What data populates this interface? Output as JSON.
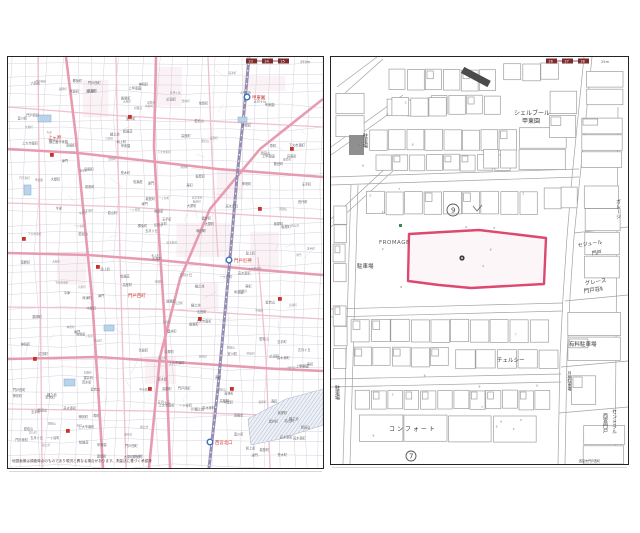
{
  "page": {
    "bg": "#ffffff"
  },
  "colors": {
    "border": "#242424",
    "road_major": "#e79bb0",
    "road_minor": "#efc0cd",
    "railway": "#968db2",
    "grid": "#cfc9d8",
    "tiny_text": "#6b6b74",
    "red": "#c9322b",
    "red_text": "#d0342c",
    "blue_stroke": "#3a6fc0",
    "pond_fill": "#b9d4ea",
    "pond_stroke": "#7fa8cc",
    "tint": "#f7e7ec",
    "river_fill": "#edf1f7",
    "river_hatch": "#9aa6bd",
    "tab_box": "#7e2b2b",
    "bldg_stroke": "#9e9e9e",
    "street": "#a3a3a3",
    "parcel_pink": "#dc4870",
    "dark_bldg": "#4a4a4a",
    "grey_bldg": "#8f8f8f",
    "label_dark": "#3a3a3a",
    "green_mark": "#3a8a4a"
  },
  "left_map": {
    "page_tabs": [
      "23",
      "24",
      "25"
    ],
    "scale_note": "250m",
    "caption": "地図画像は調査時点のものであり現況と異なる場合があります。測量法に基づく承認済",
    "railway": [
      [
        241,
        0
      ],
      [
        236,
        55
      ],
      [
        229,
        120
      ],
      [
        223,
        190
      ],
      [
        217,
        255
      ],
      [
        210,
        330
      ],
      [
        201,
        411
      ]
    ],
    "stations": [
      {
        "x": 239,
        "y": 40,
        "label": "甲東園"
      },
      {
        "x": 221,
        "y": 203,
        "label": "門戸厄神"
      },
      {
        "x": 202,
        "y": 385,
        "label": "西宮北口"
      }
    ],
    "red_labels": [
      {
        "t": "門戸西町",
        "x": 120,
        "y": 240
      },
      {
        "t": "上ヶ原",
        "x": 40,
        "y": 82
      }
    ],
    "roads_major": [
      [
        [
          0,
          92
        ],
        [
          70,
          96
        ],
        [
          140,
          104
        ],
        [
          210,
          112
        ],
        [
          315,
          120
        ]
      ],
      [
        [
          0,
          196
        ],
        [
          80,
          198
        ],
        [
          160,
          204
        ],
        [
          240,
          212
        ],
        [
          315,
          218
        ]
      ],
      [
        [
          0,
          302
        ],
        [
          90,
          300
        ],
        [
          180,
          306
        ],
        [
          270,
          312
        ],
        [
          315,
          314
        ]
      ],
      [
        [
          58,
          0
        ],
        [
          68,
          80
        ],
        [
          76,
          160
        ],
        [
          84,
          240
        ],
        [
          90,
          330
        ],
        [
          95,
          411
        ]
      ],
      [
        [
          148,
          0
        ],
        [
          146,
          90
        ],
        [
          151,
          180
        ],
        [
          157,
          270
        ],
        [
          162,
          411
        ]
      ],
      [
        [
          315,
          42
        ],
        [
          252,
          92
        ],
        [
          202,
          152
        ],
        [
          172,
          222
        ],
        [
          152,
          300
        ],
        [
          141,
          411
        ]
      ]
    ],
    "roads_minor": [
      [
        [
          0,
          50
        ],
        [
          100,
          58
        ],
        [
          200,
          64
        ],
        [
          315,
          70
        ]
      ],
      [
        [
          0,
          146
        ],
        [
          120,
          150
        ],
        [
          240,
          158
        ],
        [
          315,
          162
        ]
      ],
      [
        [
          0,
          250
        ],
        [
          150,
          252
        ],
        [
          315,
          262
        ]
      ],
      [
        [
          0,
          352
        ],
        [
          140,
          354
        ],
        [
          315,
          360
        ]
      ],
      [
        [
          30,
          0
        ],
        [
          34,
          411
        ]
      ],
      [
        [
          108,
          0
        ],
        [
          112,
          200
        ],
        [
          118,
          411
        ]
      ],
      [
        [
          200,
          0
        ],
        [
          204,
          100
        ],
        [
          210,
          200
        ]
      ],
      [
        [
          250,
          200
        ],
        [
          258,
          300
        ],
        [
          262,
          411
        ]
      ]
    ],
    "red_squares": [
      [
        58,
        372
      ],
      [
        25,
        300
      ],
      [
        88,
        208
      ],
      [
        140,
        330
      ],
      [
        250,
        150
      ],
      [
        42,
        96
      ],
      [
        190,
        260
      ],
      [
        282,
        90
      ],
      [
        120,
        58
      ],
      [
        222,
        330
      ],
      [
        270,
        240
      ],
      [
        14,
        180
      ]
    ],
    "ponds": [
      [
        30,
        58,
        13,
        7
      ],
      [
        96,
        268,
        10,
        6
      ],
      [
        56,
        322,
        11,
        7
      ],
      [
        16,
        128,
        7,
        10
      ],
      [
        230,
        60,
        9,
        5
      ]
    ],
    "river": "240,362 278,342 315,332 315,368 272,382 243,388",
    "scatter_names": [
      "上甲東園",
      "甲東園",
      "段上町",
      "上大市南町",
      "下大市東町",
      "門戸東町",
      "門戸西町",
      "岡田山",
      "神呪町",
      "樋之池",
      "荒木町",
      "薬師町",
      "丸橋町",
      "高木東町",
      "伏原町",
      "一ヶ谷町",
      "松籟荘",
      "若山町",
      "大屋町",
      "中屋町",
      "板屋町",
      "能登町",
      "郷免町",
      "玉手町",
      "室川町",
      "寿町",
      "常磐町",
      "和上町",
      "染殿町",
      "津門",
      "今津",
      "広田町",
      "愛宕山",
      "六軒町",
      "藤田町",
      "深津町",
      "高座町",
      "田代町",
      "五月ヶ丘",
      "雲井町"
    ]
  },
  "right_map": {
    "page_tabs": [
      "26",
      "27",
      "28"
    ],
    "scale_note": "25m",
    "parcel_points": "78,177 112,175 148,173 182,177 215,181 214,204 213,227 176,229 140,231 108,228 77,224",
    "labels": [
      {
        "t": "シェルブール",
        "x": 183,
        "y": 58,
        "s": 6
      },
      {
        "t": "甲東園",
        "x": 191,
        "y": 66,
        "s": 6
      },
      {
        "t": "FROMAGE",
        "x": 48,
        "y": 187,
        "s": 5.5,
        "c": "#5a5a5a",
        "ls": 0.5
      },
      {
        "t": "駐車場",
        "x": 26,
        "y": 211,
        "s": 5.5
      },
      {
        "t": "チェルシー",
        "x": 166,
        "y": 305,
        "s": 5.5
      },
      {
        "t": "コンフォート",
        "x": 58,
        "y": 374,
        "s": 6,
        "ls": 2
      },
      {
        "t": "有料駐車場",
        "x": 238,
        "y": 289,
        "s": 5.5
      },
      {
        "t": "グレース",
        "x": 254,
        "y": 228,
        "s": 5.5,
        "r": -8
      },
      {
        "t": "門戸荘Ⅱ",
        "x": 253,
        "y": 236,
        "s": 5.5,
        "r": -8
      },
      {
        "t": "セジュール",
        "x": 247,
        "y": 190,
        "s": 5,
        "r": -8
      },
      {
        "t": "門戸",
        "x": 261,
        "y": 198,
        "s": 5,
        "r": -8
      },
      {
        "t": "駐車場",
        "x": 6,
        "y": 328,
        "s": 5,
        "vert": true
      },
      {
        "t": "駐車場",
        "x": 34,
        "y": 76,
        "s": 5,
        "vert": true
      },
      {
        "t": "ガレージ",
        "x": 287,
        "y": 142,
        "s": 5,
        "vert": true
      },
      {
        "t": "月極駐車場",
        "x": 239,
        "y": 314,
        "s": 4,
        "vert": true
      },
      {
        "t": "セントラル",
        "x": 283,
        "y": 352,
        "s": 5,
        "vert": true
      },
      {
        "t": "西宮門戸",
        "x": 274,
        "y": 356,
        "s": 5,
        "vert": true
      },
      {
        "t": "西宮市門戸西町",
        "x": 248,
        "y": 405,
        "s": 3
      }
    ],
    "circled_numbers": [
      {
        "t": "9",
        "x": 122,
        "y": 153,
        "r": 6
      },
      {
        "t": "7",
        "x": 80,
        "y": 399,
        "r": 5
      }
    ],
    "check_mark": {
      "x": 146,
      "y": 152
    },
    "tiny_marks": [
      "2",
      "3",
      "4",
      "5",
      "6",
      "7",
      "8",
      "9",
      "11",
      "13"
    ],
    "streets": [
      [
        [
          0,
          120
        ],
        [
          248,
          112
        ]
      ],
      [
        [
          0,
          128
        ],
        [
          248,
          120
        ]
      ],
      [
        [
          0,
          252
        ],
        [
          232,
          246
        ]
      ],
      [
        [
          0,
          260
        ],
        [
          232,
          254
        ]
      ],
      [
        [
          0,
          322
        ],
        [
          230,
          317
        ]
      ],
      [
        [
          0,
          330
        ],
        [
          230,
          325
        ]
      ],
      [
        [
          253,
          0
        ],
        [
          247,
          60
        ],
        [
          241,
          120
        ],
        [
          236,
          180
        ],
        [
          232,
          240
        ],
        [
          229,
          300
        ],
        [
          227,
          407
        ]
      ],
      [
        [
          261,
          0
        ],
        [
          255,
          60
        ],
        [
          249,
          120
        ],
        [
          243,
          180
        ],
        [
          239,
          240
        ],
        [
          236,
          300
        ],
        [
          234,
          407
        ]
      ],
      [
        [
          287,
          50
        ],
        [
          284,
          407
        ]
      ],
      [
        [
          0,
          90
        ],
        [
          72,
          38
        ]
      ],
      [
        [
          0,
          98
        ],
        [
          76,
          44
        ]
      ],
      [
        [
          6,
          30
        ],
        [
          46,
          0
        ]
      ],
      [
        [
          14,
          36
        ],
        [
          52,
          2
        ]
      ],
      [
        [
          0,
          162
        ],
        [
          58,
          108
        ]
      ],
      [
        [
          0,
          170
        ],
        [
          62,
          114
        ]
      ],
      [
        [
          243,
          176
        ],
        [
          297,
          170
        ]
      ],
      [
        [
          234,
          244
        ],
        [
          297,
          238
        ]
      ],
      [
        [
          230,
          310
        ],
        [
          297,
          304
        ]
      ],
      [
        [
          228,
          356
        ],
        [
          297,
          350
        ]
      ],
      [
        [
          20,
          128
        ],
        [
          12,
          407
        ]
      ],
      [
        [
          27,
          128
        ],
        [
          19,
          407
        ]
      ]
    ],
    "building_bands": [
      {
        "x": 58,
        "y": 12,
        "w": 108,
        "h": 22,
        "n": 6
      },
      {
        "x": 172,
        "y": 6,
        "w": 56,
        "h": 18,
        "n": 3
      },
      {
        "x": 100,
        "y": 38,
        "w": 70,
        "h": 20,
        "n": 4
      },
      {
        "x": 55,
        "y": 42,
        "w": 40,
        "h": 18,
        "n": 2
      },
      {
        "x": 38,
        "y": 72,
        "w": 148,
        "h": 22,
        "n": 8
      },
      {
        "x": 44,
        "y": 97,
        "w": 136,
        "h": 17,
        "n": 8
      },
      {
        "x": 188,
        "y": 70,
        "w": 48,
        "h": 44,
        "n": 2,
        "vert": true
      },
      {
        "x": 152,
        "y": 92,
        "w": 34,
        "h": 20,
        "n": 2
      },
      {
        "x": 255,
        "y": 14,
        "w": 38,
        "h": 34,
        "n": 2,
        "vert": true
      },
      {
        "x": 250,
        "y": 60,
        "w": 42,
        "h": 52,
        "n": 3,
        "vert": true
      },
      {
        "x": 35,
        "y": 134,
        "w": 172,
        "h": 24,
        "n": 9
      },
      {
        "x": 212,
        "y": 130,
        "w": 36,
        "h": 22,
        "n": 2
      },
      {
        "x": 253,
        "y": 128,
        "w": 36,
        "h": 94,
        "n": 4,
        "vert": true
      },
      {
        "x": 2,
        "y": 148,
        "w": 14,
        "h": 78,
        "n": 4,
        "vert": true
      },
      {
        "x": 2,
        "y": 248,
        "w": 14,
        "h": 64,
        "n": 3,
        "vert": true
      },
      {
        "x": 20,
        "y": 262,
        "w": 198,
        "h": 24,
        "n": 10
      },
      {
        "x": 22,
        "y": 290,
        "w": 96,
        "h": 20,
        "n": 5
      },
      {
        "x": 124,
        "y": 292,
        "w": 104,
        "h": 20,
        "n": 5
      },
      {
        "x": 24,
        "y": 333,
        "w": 196,
        "h": 20,
        "n": 12
      },
      {
        "x": 28,
        "y": 358,
        "w": 178,
        "h": 28,
        "n": 4
      },
      {
        "x": 236,
        "y": 255,
        "w": 54,
        "h": 50,
        "n": 2,
        "vert": true
      },
      {
        "x": 240,
        "y": 318,
        "w": 26,
        "h": 30,
        "n": 1
      },
      {
        "x": 252,
        "y": 368,
        "w": 42,
        "h": 40,
        "n": 2,
        "vert": true
      },
      {
        "x": 60,
        "y": 40,
        "w": 56,
        "h": 20,
        "n": 3
      },
      {
        "x": 4,
        "y": 36,
        "w": 30,
        "h": 44,
        "n": 2,
        "vert": true
      },
      {
        "x": 218,
        "y": 34,
        "w": 28,
        "h": 48,
        "n": 2,
        "vert": true
      }
    ],
    "grey_building": {
      "x": 18,
      "y": 78,
      "w": 15,
      "h": 20
    },
    "dark_building": {
      "x": 130,
      "y": 16,
      "w": 7,
      "h": 30,
      "rot": -62
    },
    "green_mark": {
      "x": 68,
      "y": 167
    }
  }
}
